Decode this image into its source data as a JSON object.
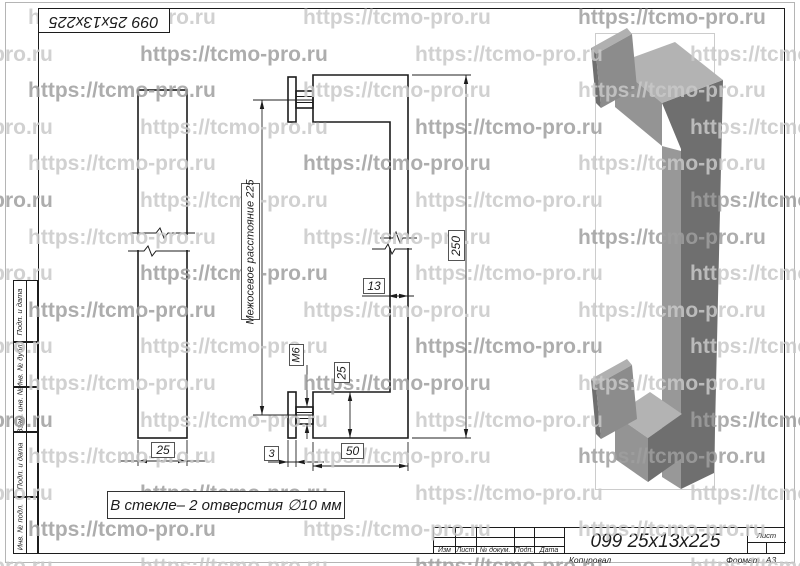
{
  "watermark": {
    "text": "https://tcmo-pro.ru"
  },
  "stamp": {
    "rotated_title": "099 25x13x225"
  },
  "views": {
    "note": "В стекле– 2 отверстия ∅10 мм"
  },
  "dimensions": {
    "interaxial_label": "Межосевое расстояние 225",
    "overall_length": "250",
    "bar_thickness": "13",
    "thread": "М6",
    "arm_height": "25",
    "plate_thickness": "3",
    "arm_length": "50",
    "bar_width": "25"
  },
  "side_strip": {
    "labels": [
      "Подп. и дата",
      "Инв. № дубл.",
      "Взам. инв. №",
      "Подп. и дата",
      "Инв. № подл."
    ]
  },
  "title_block": {
    "cols": [
      "Изм",
      "Лист",
      "№ докум.",
      "Подп.",
      "Дата"
    ],
    "doc_title": "099 25x13x225",
    "sheet_label": "Лист",
    "copied": "Копировал",
    "format_label": "Формат",
    "format_value": "А3"
  }
}
